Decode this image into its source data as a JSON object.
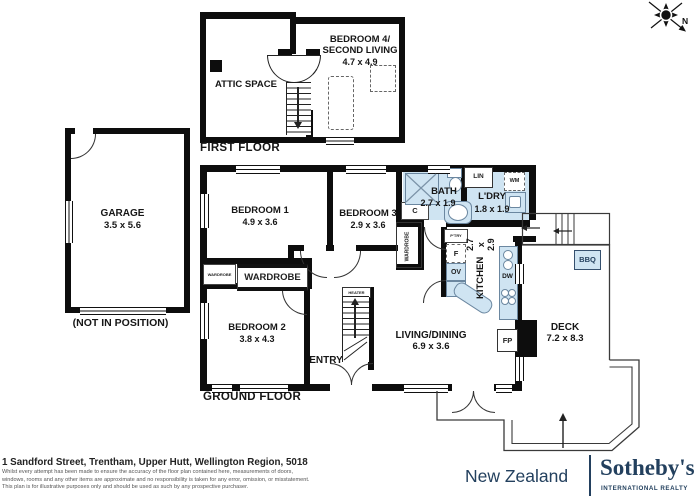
{
  "compass": {
    "north_label": "N"
  },
  "first_floor": {
    "title": "FIRST FLOOR",
    "attic": {
      "name": "ATTIC SPACE"
    },
    "bedroom4": {
      "line1": "BEDROOM 4/",
      "line2": "SECOND LIVING",
      "dims": "4.7 x 4.9"
    }
  },
  "garage": {
    "name": "GARAGE",
    "dims": "3.5 x 5.6",
    "note": "(NOT IN POSITION)"
  },
  "ground_floor": {
    "title": "GROUND FLOOR",
    "rooms": {
      "bedroom1": {
        "name": "BEDROOM 1",
        "dims": "4.9 x 3.6"
      },
      "bedroom2": {
        "name": "BEDROOM 2",
        "dims": "3.8 x 4.3"
      },
      "bedroom3": {
        "name": "BEDROOM 3",
        "dims": "2.9 x 3.6"
      },
      "bath": {
        "name": "BATH",
        "dims": "2.7 x 1.9"
      },
      "laundry": {
        "name": "L'DRY",
        "dims": "1.8 x 1.9"
      },
      "kitchen": {
        "name": "KITCHEN",
        "dims": "2.7 x 2.9"
      },
      "living": {
        "name": "LIVING/DINING",
        "dims": "6.9 x 3.6"
      },
      "entry": {
        "name": "ENTRY"
      },
      "deck": {
        "name": "DECK",
        "dims": "7.2 x 8.3"
      }
    },
    "fixtures": {
      "wardrobe_main": "WARDROBE",
      "wardrobe_small": "WARDROBE",
      "wardrobe_side": "WARDROBE",
      "heater": "HEATER",
      "cupboard": "C",
      "linen": "LIN",
      "washing_machine": "WM",
      "pantry": "P'TRY",
      "fridge": "F",
      "oven": "OV",
      "dishwasher": "DW",
      "fireplace": "FP",
      "bbq": "BBQ"
    }
  },
  "footer": {
    "address": "1 Sandford Street, Trentham, Upper Hutt, Wellington Region, 5018",
    "disclaimer_line1": "Whilst every attempt has been made to ensure the accuracy of the floor plan contained here, measurements of doors,",
    "disclaimer_line2": "windows, rooms and any other items are approximate and no responsibility is taken for any error, omission, or misstatement.",
    "disclaimer_line3": "This plan is for illustrative purposes only and should be used as such by any prospective purchaser."
  },
  "brand": {
    "region": "New Zealand",
    "name": "Sotheby's",
    "tagline": "INTERNATIONAL REALTY"
  },
  "colors": {
    "wet_area_blue": "#cfe4f2",
    "brand_navy": "#23405e",
    "wall_black": "#0d0d0d"
  }
}
